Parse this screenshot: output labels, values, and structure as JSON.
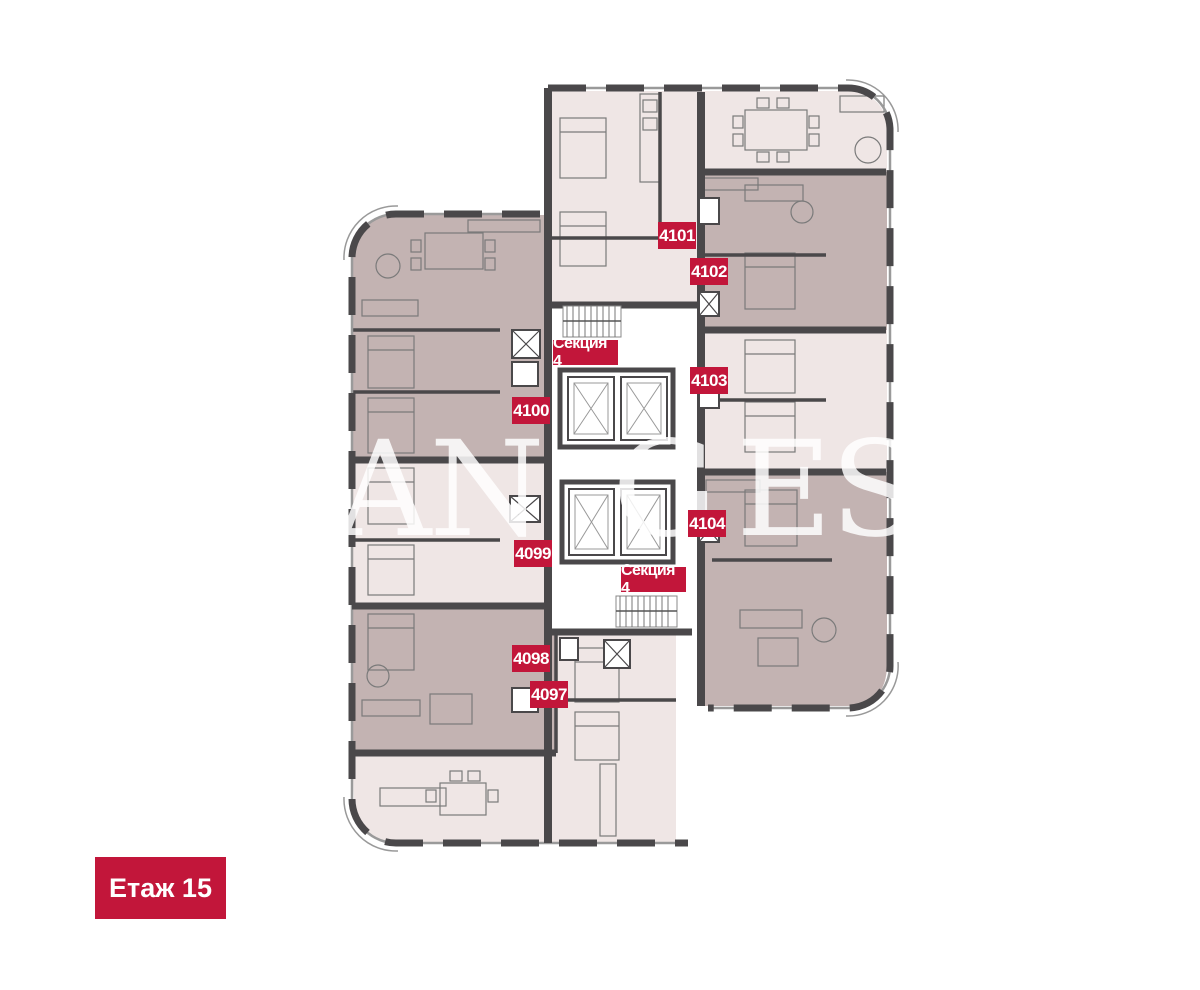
{
  "badges": {
    "floor": "Етаж 15",
    "section_top": "Секция 4",
    "section_bottom": "Секция 4",
    "units": {
      "u4101": "4101",
      "u4102": "4102",
      "u4103": "4103",
      "u4104": "4104",
      "u4100": "4100",
      "u4099": "4099",
      "u4098": "4098",
      "u4097": "4097"
    }
  },
  "watermark": {
    "parts": [
      "AN",
      "G",
      "EST"
    ]
  },
  "colors": {
    "badge_red": "#c2163a",
    "unit_fill_light": "#efe6e5",
    "unit_fill_dark": "#c3b3b2",
    "wall": "#4a484a",
    "background": "#ffffff"
  }
}
